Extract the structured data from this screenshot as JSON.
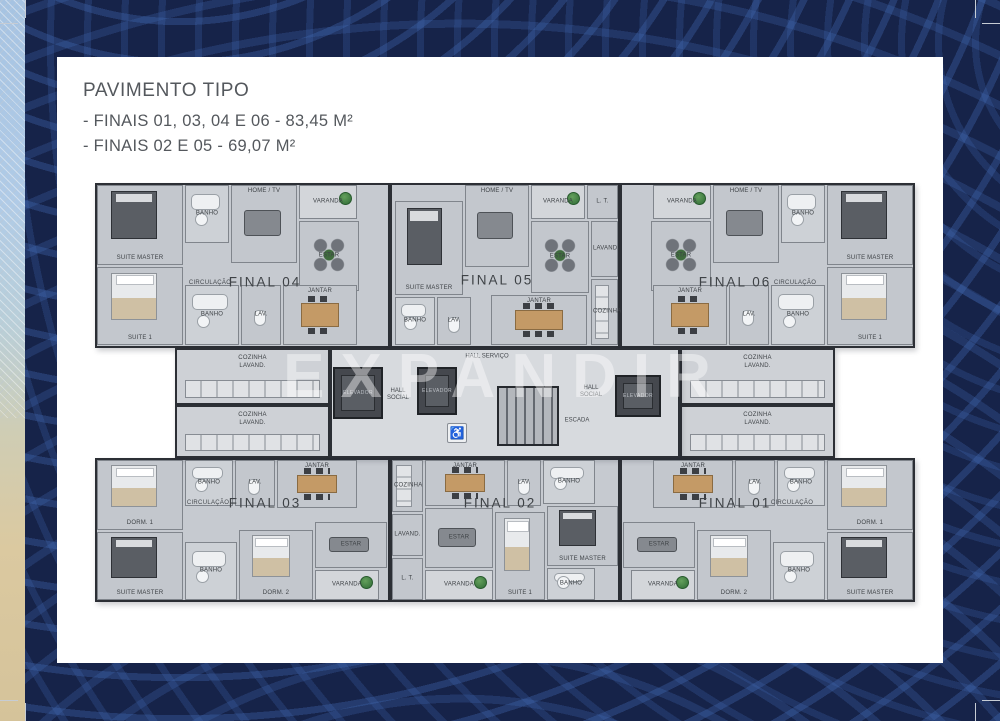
{
  "header": {
    "title": "PAVIMENTO TIPO",
    "line1": "- FINAIS 01, 03, 04 E 06 - 83,45 M²",
    "line2": "- FINAIS 02 E 05 - 69,07 M²"
  },
  "plan": {
    "watermark": "EXPANDIR",
    "circ_label": "CIRCULAÇÃO",
    "core": {
      "box": {
        "x": 235,
        "y": 165,
        "w": 350,
        "h": 110
      },
      "elevator_label": "ELEVADOR",
      "elevators": [
        {
          "x": 238,
          "y": 184,
          "w": 50,
          "h": 52
        },
        {
          "x": 322,
          "y": 184,
          "w": 40,
          "h": 48
        },
        {
          "x": 520,
          "y": 192,
          "w": 46,
          "h": 42
        }
      ],
      "stairs": {
        "x": 402,
        "y": 203,
        "w": 62,
        "h": 60
      },
      "labels": [
        {
          "t": "HALL SERVIÇO",
          "x": 392,
          "y": 174
        },
        {
          "t": "HALL\nSOCIAL",
          "x": 303,
          "y": 212
        },
        {
          "t": "HALL\nSOCIAL",
          "x": 496,
          "y": 209
        },
        {
          "t": "ESCADA",
          "x": 482,
          "y": 238
        }
      ],
      "wheelchair": {
        "x": 352,
        "y": 240,
        "w": 20,
        "h": 20,
        "glyph": "♿"
      }
    },
    "units": [
      {
        "id": "final-04",
        "label": "FINAL 04",
        "lx": 170,
        "ly": 99,
        "circ": {
          "x": 115,
          "y": 100
        },
        "box": {
          "x": 0,
          "y": 0,
          "w": 295,
          "h": 165
        },
        "annex": {
          "x": 80,
          "y": 165,
          "w": 155,
          "h": 57,
          "label": "COZINHA\nLAVAND."
        },
        "rooms": [
          {
            "n": "SUITE MASTER",
            "x": 2,
            "y": 2,
            "w": 86,
            "h": 80,
            "f": "bed-dark",
            "lp": "b"
          },
          {
            "n": "SUITE 1",
            "x": 2,
            "y": 84,
            "w": 86,
            "h": 78,
            "f": "bed-light",
            "lp": "b"
          },
          {
            "n": "BANHO",
            "x": 90,
            "y": 2,
            "w": 44,
            "h": 58,
            "f": "bath"
          },
          {
            "n": "HOME / TV",
            "x": 136,
            "y": 2,
            "w": 66,
            "h": 78,
            "f": "sofa",
            "lp": "t"
          },
          {
            "n": "VARANDA",
            "x": 204,
            "y": 2,
            "w": 58,
            "h": 34,
            "f": "plant"
          },
          {
            "n": "ESTAR",
            "x": 204,
            "y": 38,
            "w": 60,
            "h": 70,
            "f": "chairs"
          },
          {
            "n": "BANHO",
            "x": 90,
            "y": 102,
            "w": 54,
            "h": 60,
            "f": "bath"
          },
          {
            "n": "LAV.",
            "x": 146,
            "y": 102,
            "w": 40,
            "h": 60,
            "f": "wc"
          },
          {
            "n": "JANTAR",
            "x": 188,
            "y": 102,
            "w": 74,
            "h": 60,
            "f": "table",
            "lp": "t"
          }
        ]
      },
      {
        "id": "final-05",
        "label": "FINAL 05",
        "lx": 402,
        "ly": 97,
        "box": {
          "x": 295,
          "y": 0,
          "w": 230,
          "h": 165
        },
        "rooms": [
          {
            "n": "SUITE MASTER",
            "x": 300,
            "y": 18,
            "w": 68,
            "h": 94,
            "f": "bed-dark",
            "lp": "b"
          },
          {
            "n": "HOME / TV",
            "x": 370,
            "y": 2,
            "w": 64,
            "h": 82,
            "f": "sofa",
            "lp": "t"
          },
          {
            "n": "VARANDA",
            "x": 436,
            "y": 2,
            "w": 54,
            "h": 34,
            "f": "plant"
          },
          {
            "n": "L. T.",
            "x": 492,
            "y": 2,
            "w": 31,
            "h": 34
          },
          {
            "n": "ESTAR",
            "x": 436,
            "y": 38,
            "w": 58,
            "h": 72,
            "f": "chairs"
          },
          {
            "n": "LAVAND.",
            "x": 496,
            "y": 38,
            "w": 27,
            "h": 56
          },
          {
            "n": "COZINHA",
            "x": 496,
            "y": 96,
            "w": 27,
            "h": 66,
            "f": "counter"
          },
          {
            "n": "BANHO",
            "x": 300,
            "y": 114,
            "w": 40,
            "h": 48,
            "f": "bath"
          },
          {
            "n": "LAV.",
            "x": 342,
            "y": 114,
            "w": 34,
            "h": 48,
            "f": "wc"
          },
          {
            "n": "JANTAR",
            "x": 396,
            "y": 112,
            "w": 96,
            "h": 50,
            "f": "table",
            "lp": "t"
          }
        ]
      },
      {
        "id": "final-06",
        "label": "FINAL 06",
        "lx": 640,
        "ly": 99,
        "circ": {
          "x": 700,
          "y": 100
        },
        "box": {
          "x": 525,
          "y": 0,
          "w": 295,
          "h": 165
        },
        "annex": {
          "x": 585,
          "y": 165,
          "w": 155,
          "h": 57,
          "label": "COZINHA\nLAVAND."
        },
        "rooms": [
          {
            "n": "SUITE MASTER",
            "x": 732,
            "y": 2,
            "w": 86,
            "h": 80,
            "f": "bed-dark",
            "lp": "b"
          },
          {
            "n": "SUITE 1",
            "x": 732,
            "y": 84,
            "w": 86,
            "h": 78,
            "f": "bed-light",
            "lp": "b"
          },
          {
            "n": "BANHO",
            "x": 686,
            "y": 2,
            "w": 44,
            "h": 58,
            "f": "bath"
          },
          {
            "n": "HOME / TV",
            "x": 618,
            "y": 2,
            "w": 66,
            "h": 78,
            "f": "sofa",
            "lp": "t"
          },
          {
            "n": "VARANDA",
            "x": 558,
            "y": 2,
            "w": 58,
            "h": 34,
            "f": "plant"
          },
          {
            "n": "ESTAR",
            "x": 556,
            "y": 38,
            "w": 60,
            "h": 70,
            "f": "chairs"
          },
          {
            "n": "BANHO",
            "x": 676,
            "y": 102,
            "w": 54,
            "h": 60,
            "f": "bath"
          },
          {
            "n": "LAV.",
            "x": 634,
            "y": 102,
            "w": 40,
            "h": 60,
            "f": "wc"
          },
          {
            "n": "JANTAR",
            "x": 558,
            "y": 102,
            "w": 74,
            "h": 60,
            "f": "table",
            "lp": "t"
          }
        ]
      },
      {
        "id": "final-03",
        "label": "FINAL 03",
        "lx": 170,
        "ly": 320,
        "circ": {
          "x": 113,
          "y": 320
        },
        "box": {
          "x": 0,
          "y": 275,
          "w": 295,
          "h": 144
        },
        "annex": {
          "x": 80,
          "y": 222,
          "w": 155,
          "h": 53,
          "label": "COZINHA\nLAVAND."
        },
        "rooms": [
          {
            "n": "DORM. 1",
            "x": 2,
            "y": 277,
            "w": 86,
            "h": 70,
            "f": "bed-light",
            "lp": "b"
          },
          {
            "n": "SUITE MASTER",
            "x": 2,
            "y": 349,
            "w": 86,
            "h": 68,
            "f": "bed-dark",
            "lp": "b"
          },
          {
            "n": "BANHO",
            "x": 90,
            "y": 277,
            "w": 48,
            "h": 46,
            "f": "bath"
          },
          {
            "n": "LAV.",
            "x": 140,
            "y": 277,
            "w": 40,
            "h": 46,
            "f": "wc"
          },
          {
            "n": "JANTAR",
            "x": 182,
            "y": 277,
            "w": 80,
            "h": 48,
            "f": "table",
            "lp": "t"
          },
          {
            "n": "BANHO",
            "x": 90,
            "y": 359,
            "w": 52,
            "h": 58,
            "f": "bath"
          },
          {
            "n": "DORM. 2",
            "x": 144,
            "y": 347,
            "w": 74,
            "h": 70,
            "f": "bed-light",
            "lp": "b"
          },
          {
            "n": "ESTAR",
            "x": 220,
            "y": 339,
            "w": 72,
            "h": 46,
            "f": "sofa"
          },
          {
            "n": "VARANDA",
            "x": 220,
            "y": 387,
            "w": 64,
            "h": 30,
            "f": "plant"
          }
        ]
      },
      {
        "id": "final-02",
        "label": "FINAL 02",
        "lx": 405,
        "ly": 320,
        "box": {
          "x": 295,
          "y": 275,
          "w": 230,
          "h": 144
        },
        "rooms": [
          {
            "n": "COZINHA",
            "x": 297,
            "y": 277,
            "w": 31,
            "h": 52,
            "f": "counter"
          },
          {
            "n": "LAVAND.",
            "x": 297,
            "y": 331,
            "w": 31,
            "h": 42
          },
          {
            "n": "L. T.",
            "x": 297,
            "y": 375,
            "w": 31,
            "h": 42
          },
          {
            "n": "JANTAR",
            "x": 330,
            "y": 277,
            "w": 80,
            "h": 46,
            "f": "table",
            "lp": "t"
          },
          {
            "n": "LAV.",
            "x": 412,
            "y": 277,
            "w": 34,
            "h": 46,
            "f": "wc"
          },
          {
            "n": "BANHO",
            "x": 448,
            "y": 277,
            "w": 52,
            "h": 44,
            "f": "bath"
          },
          {
            "n": "SUITE MASTER",
            "x": 452,
            "y": 323,
            "w": 71,
            "h": 60,
            "f": "bed-dark",
            "lp": "b"
          },
          {
            "n": "ESTAR",
            "x": 330,
            "y": 325,
            "w": 68,
            "h": 60,
            "f": "sofa"
          },
          {
            "n": "SUITE 1",
            "x": 400,
            "y": 329,
            "w": 50,
            "h": 88,
            "f": "bed-light",
            "lp": "b"
          },
          {
            "n": "BANHO",
            "x": 452,
            "y": 385,
            "w": 48,
            "h": 32,
            "f": "bath"
          },
          {
            "n": "VARANDA",
            "x": 330,
            "y": 387,
            "w": 68,
            "h": 30,
            "f": "plant"
          }
        ]
      },
      {
        "id": "final-01",
        "label": "FINAL 01",
        "lx": 640,
        "ly": 320,
        "circ": {
          "x": 697,
          "y": 320
        },
        "box": {
          "x": 525,
          "y": 275,
          "w": 295,
          "h": 144
        },
        "annex": {
          "x": 585,
          "y": 222,
          "w": 155,
          "h": 53,
          "label": "COZINHA\nLAVAND."
        },
        "rooms": [
          {
            "n": "DORM. 1",
            "x": 732,
            "y": 277,
            "w": 86,
            "h": 70,
            "f": "bed-light",
            "lp": "b"
          },
          {
            "n": "SUITE MASTER",
            "x": 732,
            "y": 349,
            "w": 86,
            "h": 68,
            "f": "bed-dark",
            "lp": "b"
          },
          {
            "n": "BANHO",
            "x": 682,
            "y": 277,
            "w": 48,
            "h": 46,
            "f": "bath"
          },
          {
            "n": "LAV.",
            "x": 640,
            "y": 277,
            "w": 40,
            "h": 46,
            "f": "wc"
          },
          {
            "n": "JANTAR",
            "x": 558,
            "y": 277,
            "w": 80,
            "h": 48,
            "f": "table",
            "lp": "t"
          },
          {
            "n": "BANHO",
            "x": 678,
            "y": 359,
            "w": 52,
            "h": 58,
            "f": "bath"
          },
          {
            "n": "DORM. 2",
            "x": 602,
            "y": 347,
            "w": 74,
            "h": 70,
            "f": "bed-light",
            "lp": "b"
          },
          {
            "n": "ESTAR",
            "x": 528,
            "y": 339,
            "w": 72,
            "h": 46,
            "f": "sofa"
          },
          {
            "n": "VARANDA",
            "x": 536,
            "y": 387,
            "w": 64,
            "h": 30,
            "f": "plant"
          }
        ]
      }
    ]
  }
}
